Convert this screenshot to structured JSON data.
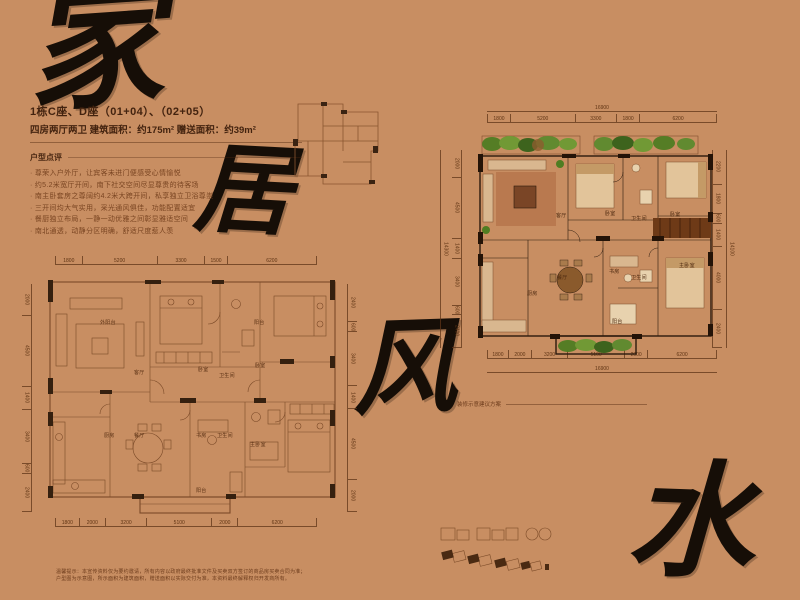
{
  "page_bg": "#c88e62",
  "calligraphy": {
    "char1": "家",
    "char2": "居",
    "char3": "风",
    "char4": "水"
  },
  "header": {
    "title": "1栋C座、D座（01+04）、（02+05）",
    "subtitle": "四房两厅两卫 建筑面积：约175m²  赠送面积：约39m²",
    "review_title": "户型点评",
    "bullets": [
      "· 尊荣入户外厅，让宾客未进门便感受心情愉悦",
      "· 约5.2米宽厅开间，南下社交空间尽显尊贵的待客场",
      "· 南主卧套房之尊阔约4.2米大跨开间，私享独立卫浴尊崇",
      "· 三开间均大气实用，采光通风俱佳，功能配置适宜",
      "· 餐厨独立布局，一静一动优雅之间彰显雅适空间",
      "· 南北通透，动静分区明确，舒适尺度惹人羡"
    ]
  },
  "plan_left": {
    "dims_top": [
      "1800",
      "5200",
      "3300",
      "1500",
      "6200"
    ],
    "dims_bottom": [
      "1800",
      "2000",
      "3200",
      "5100",
      "2000",
      "6200"
    ],
    "dims_left": [
      "2000",
      "4500",
      "1400",
      "3400",
      "600",
      "2400"
    ],
    "dims_right": [
      "2400",
      "600",
      "3400",
      "1400",
      "4500",
      "2000"
    ],
    "rooms": [
      "外阳台",
      "阳台",
      "客厅",
      "卧室",
      "卫生间",
      "卧室",
      "厨房",
      "餐厅",
      "书房",
      "卫生间",
      "主卧室",
      "阳台"
    ]
  },
  "plan_right": {
    "dims_top_total": "16900",
    "dims_top": [
      "1800",
      "5200",
      "3300",
      "1800",
      "6200"
    ],
    "dims_bottom": [
      "1800",
      "2000",
      "3200",
      "5100",
      "2000",
      "6200"
    ],
    "dims_bottom_total": "16900",
    "dims_left": [
      "2000",
      "4500",
      "1400",
      "3400",
      "600",
      "2400"
    ],
    "dims_left_total": "14300",
    "dims_right": [
      "2200",
      "1800",
      "600",
      "1400",
      "4000",
      "2400"
    ],
    "dims_right_total": "14100",
    "rooms": [
      "客厅",
      "卧室",
      "卫生间",
      "卧室",
      "厨房",
      "餐厅",
      "书房",
      "卫生间",
      "主卧室",
      "阳台"
    ]
  },
  "caption": "装修示意建议方案",
  "footer": {
    "line1": "温馨提示：本宣传资料仅为要约邀请，所有内容以政府最终批准文件及买卖双方签订的商品房买卖合同为准；",
    "line2": "户型图为示意图，所示面积为建筑面积，赠送面积以实际交付为准，本资料最终解释权归开发商所有。"
  }
}
